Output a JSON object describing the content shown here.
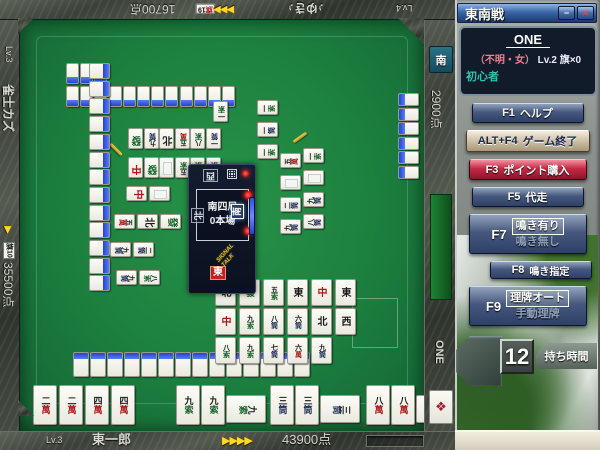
{
  "colors": {
    "felt_green": "#1c7f3e",
    "tile_back_blue": "#2144cf",
    "accent_red": "#c62943",
    "accent_gold": "#ffd825",
    "rank_teal": "#2fc2ae",
    "name_pink": "#f07f92",
    "frame_stone": "#3b4038"
  },
  "players": {
    "bottom": {
      "level": "Lv.3",
      "name": "東一郎",
      "score": "43900点",
      "arrows": "▶▶▶▶"
    },
    "left": {
      "level": "Lv.3",
      "name": "雀士カズ",
      "score": "35500点",
      "badge": "旗10",
      "arrow": "▶"
    },
    "top": {
      "level": "Lv.4",
      "name": "♪ゆき♪",
      "score": "16700点",
      "badge": "旗19",
      "arrows": "▶▶▶"
    },
    "right": {
      "name": "ONE",
      "score": "2900点",
      "seat": "南"
    }
  },
  "table": {
    "center": {
      "round": "南四局",
      "honba": "0本場",
      "winds": {
        "bottom": "東",
        "left": "北",
        "top": "西",
        "right": "南"
      },
      "signal_line1": "SIGNAL",
      "signal_line2": "TALK"
    },
    "walls": {
      "top_row2": 3,
      "top_row": 12,
      "left_col": 13,
      "bottom_row": 14,
      "right_col": 6
    },
    "discards": {
      "top": [
        [
          "一索"
        ],
        [
          "發",
          "九筒",
          "北",
          "五萬",
          "八索",
          "一筒"
        ],
        [
          "中",
          "發",
          "白",
          "五索",
          "一索",
          "一索"
        ]
      ],
      "right": [
        [
          "一索",
          "一筒",
          "一索"
        ],
        [
          "五萬",
          "白",
          "二筒",
          "九筒"
        ],
        [
          "一索",
          "白",
          "九筒",
          "八筒"
        ]
      ],
      "left": [
        [
          "中",
          "白"
        ],
        [
          "五萬",
          "北",
          "發"
        ],
        [
          "九筒",
          "二筒"
        ],
        [
          "九筒",
          "八索"
        ]
      ],
      "bottom": [
        [
          "北",
          "發",
          "五索",
          "東",
          "中",
          "東"
        ],
        [
          "中",
          "九索",
          "八筒",
          "六筒",
          "北",
          "西"
        ],
        [
          "八索",
          "九索",
          "七筒",
          "六萬",
          "九筒"
        ]
      ]
    },
    "hand": {
      "concealed": [
        "二萬",
        "二萬",
        "四萬",
        "四萬"
      ],
      "melds": [
        [
          "九索",
          "九索",
          "九索"
        ],
        [
          "三筒",
          "三筒",
          "三筒"
        ],
        [
          "八萬",
          "八萬",
          "八萬"
        ]
      ]
    }
  },
  "sidebar": {
    "title": "東南戦",
    "window": {
      "minimize_icon": "−",
      "close_icon": "✕"
    },
    "profile": {
      "name": "ONE",
      "meta_paren": "（不明・女）",
      "meta_level": "Lv.2 旗×0",
      "rank": "初心者"
    },
    "buttons": [
      {
        "key": "F1",
        "label": "ヘルプ",
        "style": "blue"
      },
      {
        "key": "ALT+F4",
        "label": "ゲーム終了",
        "style": "tan"
      },
      {
        "key": "F3",
        "label": "ポイント購入",
        "style": "red"
      },
      {
        "key": "F5",
        "label": "代走",
        "style": "blue"
      },
      {
        "key": "F7",
        "primary": "鳴き有り",
        "secondary": "鳴き無し",
        "style": "toggle"
      },
      {
        "key": "F8",
        "label": "鳴き指定",
        "style": "small"
      },
      {
        "key": "F9",
        "primary": "理牌オート",
        "secondary": "手動理牌",
        "style": "toggle"
      }
    ],
    "timer": {
      "value": "12",
      "label": "持ち時間"
    },
    "decor_tile_icon": "❖"
  }
}
